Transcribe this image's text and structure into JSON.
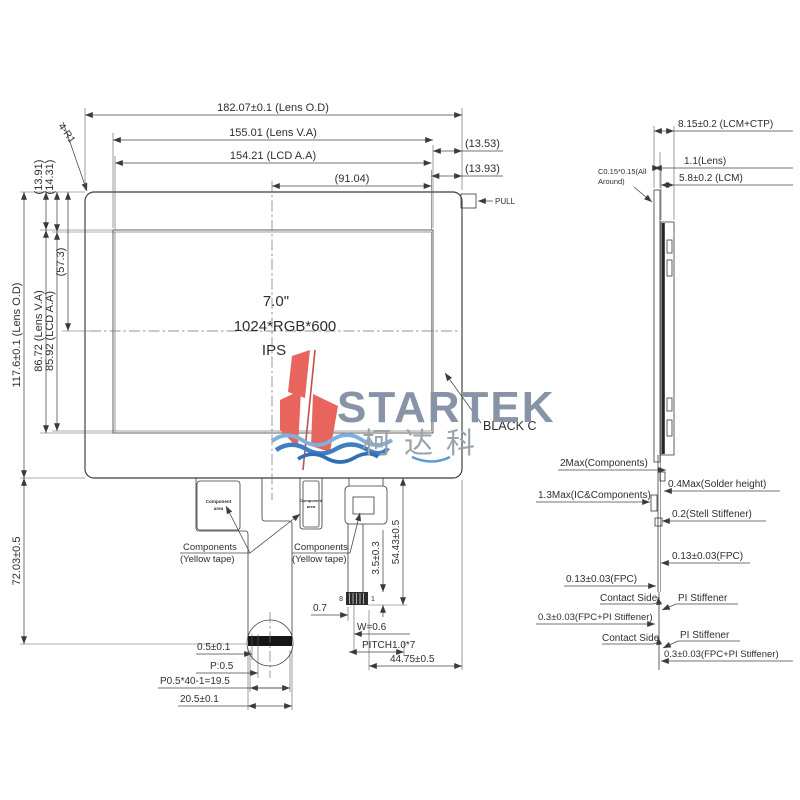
{
  "front": {
    "size": "7.0\"",
    "resolution": "1024*RGB*600",
    "panel_mode": "IPS",
    "surface_color": "BLACK C",
    "pull": "PULL",
    "corner": "4-R1",
    "dim_lens_od_w": "182.07±0.1 (Lens O.D)",
    "dim_lens_va_w": "155.01 (Lens V.A)",
    "dim_lcd_aa_w": "154.21 (LCD A.A)",
    "dim_center_w": "(91.04)",
    "dim_right_va": "(13.53)",
    "dim_right_aa": "(13.93)",
    "dim_top_va": "(13.91)",
    "dim_top_aa": "(14.31)",
    "dim_lens_od_h": "117.6±0.1 (Lens O.D)",
    "dim_lens_va_h": "86.72 (Lens V.A)",
    "dim_lcd_aa_h": "85.92 (LCD A.A)",
    "dim_center_h": "(57.3)",
    "dim_fpc_length": "72.03±0.5"
  },
  "side": {
    "dim_total": "8.15±0.2 (LCM+CTP)",
    "dim_lens": "1.1(Lens)",
    "dim_lcm": "5.8±0.2 (LCM)",
    "chamfer_line1": "C0.15*0.15(All",
    "chamfer_line2": "Around)",
    "components_max": "2Max(Components)",
    "solder": "0.4Max(Solder height)",
    "ic_components": "1.3Max(IC&Components)",
    "steel_stiffener": "0.2(Stell Stiffener)",
    "fpc_right": "0.13±0.03(FPC)",
    "fpc_left": "0.13±0.03(FPC)",
    "contact_side_1": "Contact Side",
    "pi_stiffener_1": "PI Stiffener",
    "fpc_pi_left": "0.3±0.03(FPC+PI Stiffener)",
    "contact_side_2": "Contact Side",
    "pi_stiffener_2": "PI Stiffener",
    "fpc_pi_right": "0.3±0.03(FPC+PI Stiffener)"
  },
  "bottom": {
    "component_area_line1": "Component",
    "component_area_line2": "area",
    "components_label_line1": "Components",
    "components_label_line2": "(Yellow tape)",
    "dim_margin": "0.5±0.1",
    "dim_pitch_small": "P:0.5",
    "dim_pitch_total": "P0.5*40-1=19.5",
    "dim_tail_w": "20.5±0.1",
    "dim_offset": "0.7",
    "dim_pin_w": "W=0.6",
    "dim_pitch7": "PITCH1.0*7",
    "dim_fpc_w": "44.75±0.5",
    "dim_conn_h": "3.5±0.3",
    "dim_conn_len": "54.43±0.5",
    "pin_first": "8",
    "pin_last": "1"
  },
  "logo": {
    "brand": "STARTEK",
    "cjk": "柯达科"
  },
  "colors": {
    "line": "#3a3a3a",
    "logo_text": "#8793a6",
    "logo_red": "#e8655e",
    "logo_blue": "#3f7fc1",
    "logo_blue_light": "#7fb0dd"
  }
}
